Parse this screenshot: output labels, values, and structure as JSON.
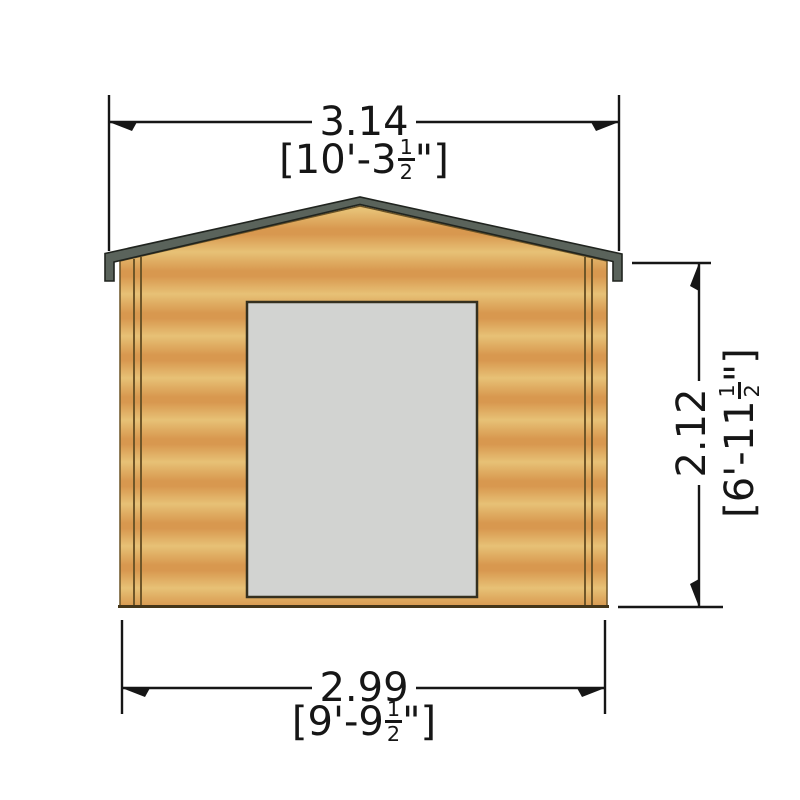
{
  "drawing": {
    "name": "Log cabin front elevation with overall dimensions"
  },
  "dimensions": {
    "top": {
      "metric": "3.14",
      "imperial_prefix": "[10'-3",
      "fraction_numerator": "1",
      "fraction_denominator": "2",
      "imperial_suffix": "\"]"
    },
    "bottom": {
      "metric": "2.99",
      "imperial_prefix": "[9'-9",
      "fraction_numerator": "1",
      "fraction_denominator": "2",
      "imperial_suffix": "\"]"
    },
    "right": {
      "metric": "2.12",
      "imperial_prefix": "[6'-11",
      "fraction_numerator": "1",
      "fraction_denominator": "2",
      "imperial_suffix": "\"]"
    }
  },
  "colors": {
    "wood_light": "#e7c176",
    "wood_dark": "#d8984f",
    "roof_trim": "#5a635b",
    "trim_outline": "#20241f",
    "door_fill": "#d2d3d1",
    "door_outline": "#35301f",
    "wall_outline": "#6b5326",
    "corner_line": "#6f5628",
    "sill": "#443619",
    "dimension": "#161616"
  }
}
